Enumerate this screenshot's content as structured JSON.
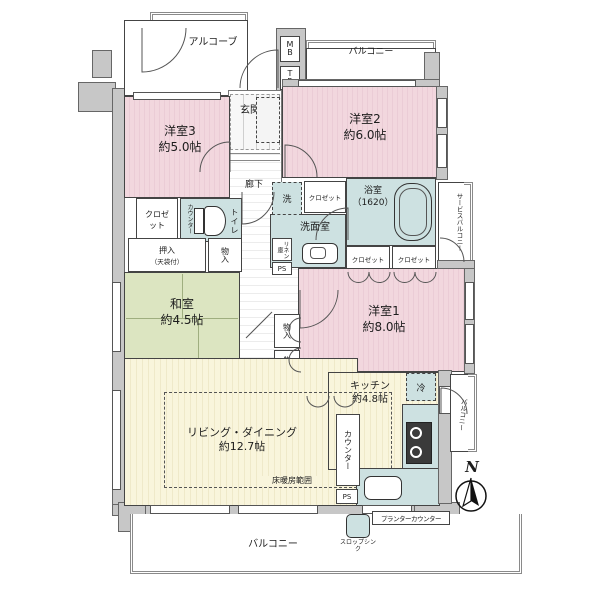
{
  "colors": {
    "room_pink": "#f2d7de",
    "tatami_green": "#dce5c1",
    "wet_teal": "#cde1e1",
    "wood_yellow": "#f9f5dc",
    "wall_gray": "#c7c7c7"
  },
  "plan": {
    "alcove": "アルコーブ",
    "mb": "MB",
    "tr": "TR",
    "balcony_top": "バルコニー",
    "balcony_bottom": "バルコニー",
    "balcony_right": "バルコニー",
    "service_balcony": "サービスバルコニー",
    "genkan": "玄関",
    "shoes_box": "シューズボックス",
    "hallway": "廊下",
    "yofu3_name": "洋室3",
    "yofu3_size": "約5.0帖",
    "yofu2_name": "洋室2",
    "yofu2_size": "約6.0帖",
    "yofu1_name": "洋室1",
    "yofu1_size": "約8.0帖",
    "washitsu_name": "和室",
    "washitsu_size": "約4.5帖",
    "kitchen_name": "キッチン",
    "kitchen_size": "約4.8帖",
    "living_name": "リビング・ダイニング",
    "living_size": "約12.7帖",
    "bath_name": "浴室",
    "bath_size": "（1620）",
    "senmen": "洗面室",
    "toilet": "トイレ",
    "washer": "洗",
    "fridge": "冷",
    "closet_hall": "クロゼット",
    "closet_bath1": "クロゼット",
    "closet_bath2": "クロゼット",
    "closet_y3": "クロゼット",
    "oshiire": "押入",
    "oshiire_note": "（天袋付）",
    "mono_a": "物入",
    "mono_b": "物入",
    "mono_c": "物入",
    "mono_d": "物入",
    "mono_e": "物入",
    "linen": "リネン庫",
    "tel": "TEL台",
    "counter_kitchen": "カウンター",
    "counter_toilet": "カウンター",
    "ps_1": "PS",
    "ps_2": "PS",
    "heating": "床暖房範囲",
    "slop_sink": "スロップシンク",
    "planter_counter": "プランターカウンター",
    "north": "N"
  }
}
